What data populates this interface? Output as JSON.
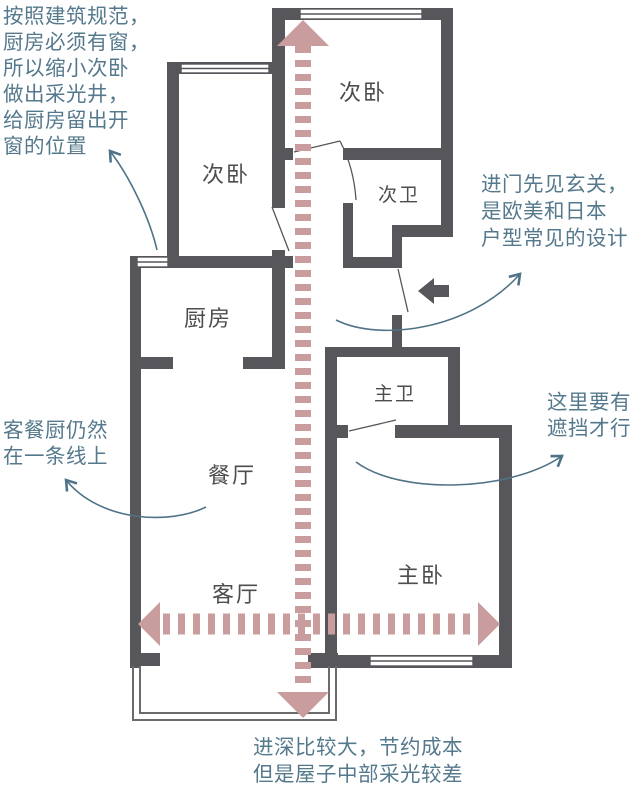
{
  "title": "apartment-floor-plan-annotated",
  "colors": {
    "wall": "#57565a",
    "dashed_arrow": "#c99d9d",
    "annotation_text": "#55798c",
    "annotation_arrow": "#4f7387",
    "room_label": "#4d4d50"
  },
  "rooms": {
    "bedroom2_left": "次卧",
    "bedroom2_right": "次卧",
    "bath2": "次卫",
    "kitchen": "厨房",
    "bath1": "主卫",
    "dining": "餐厅",
    "living": "客厅",
    "bedroom1": "主卧"
  },
  "annotations": {
    "building_code": {
      "lines": [
        "按照建筑规范，",
        "厨房必须有窗，",
        "所以缩小次卧",
        "做出采光井，",
        "给厨房留出开",
        "窗的位置"
      ]
    },
    "entry_foyer": {
      "lines": [
        "进门先见玄关，",
        "是欧美和日本",
        "户型常见的设计"
      ]
    },
    "shielding": {
      "lines": [
        "这里要有",
        "遮挡才行"
      ]
    },
    "same_line": {
      "lines": [
        "客餐厨仍然",
        "在一条线上"
      ]
    },
    "depth": {
      "lines": [
        "进深比较大，节约成本",
        "但是屋子中部采光较差"
      ]
    }
  }
}
